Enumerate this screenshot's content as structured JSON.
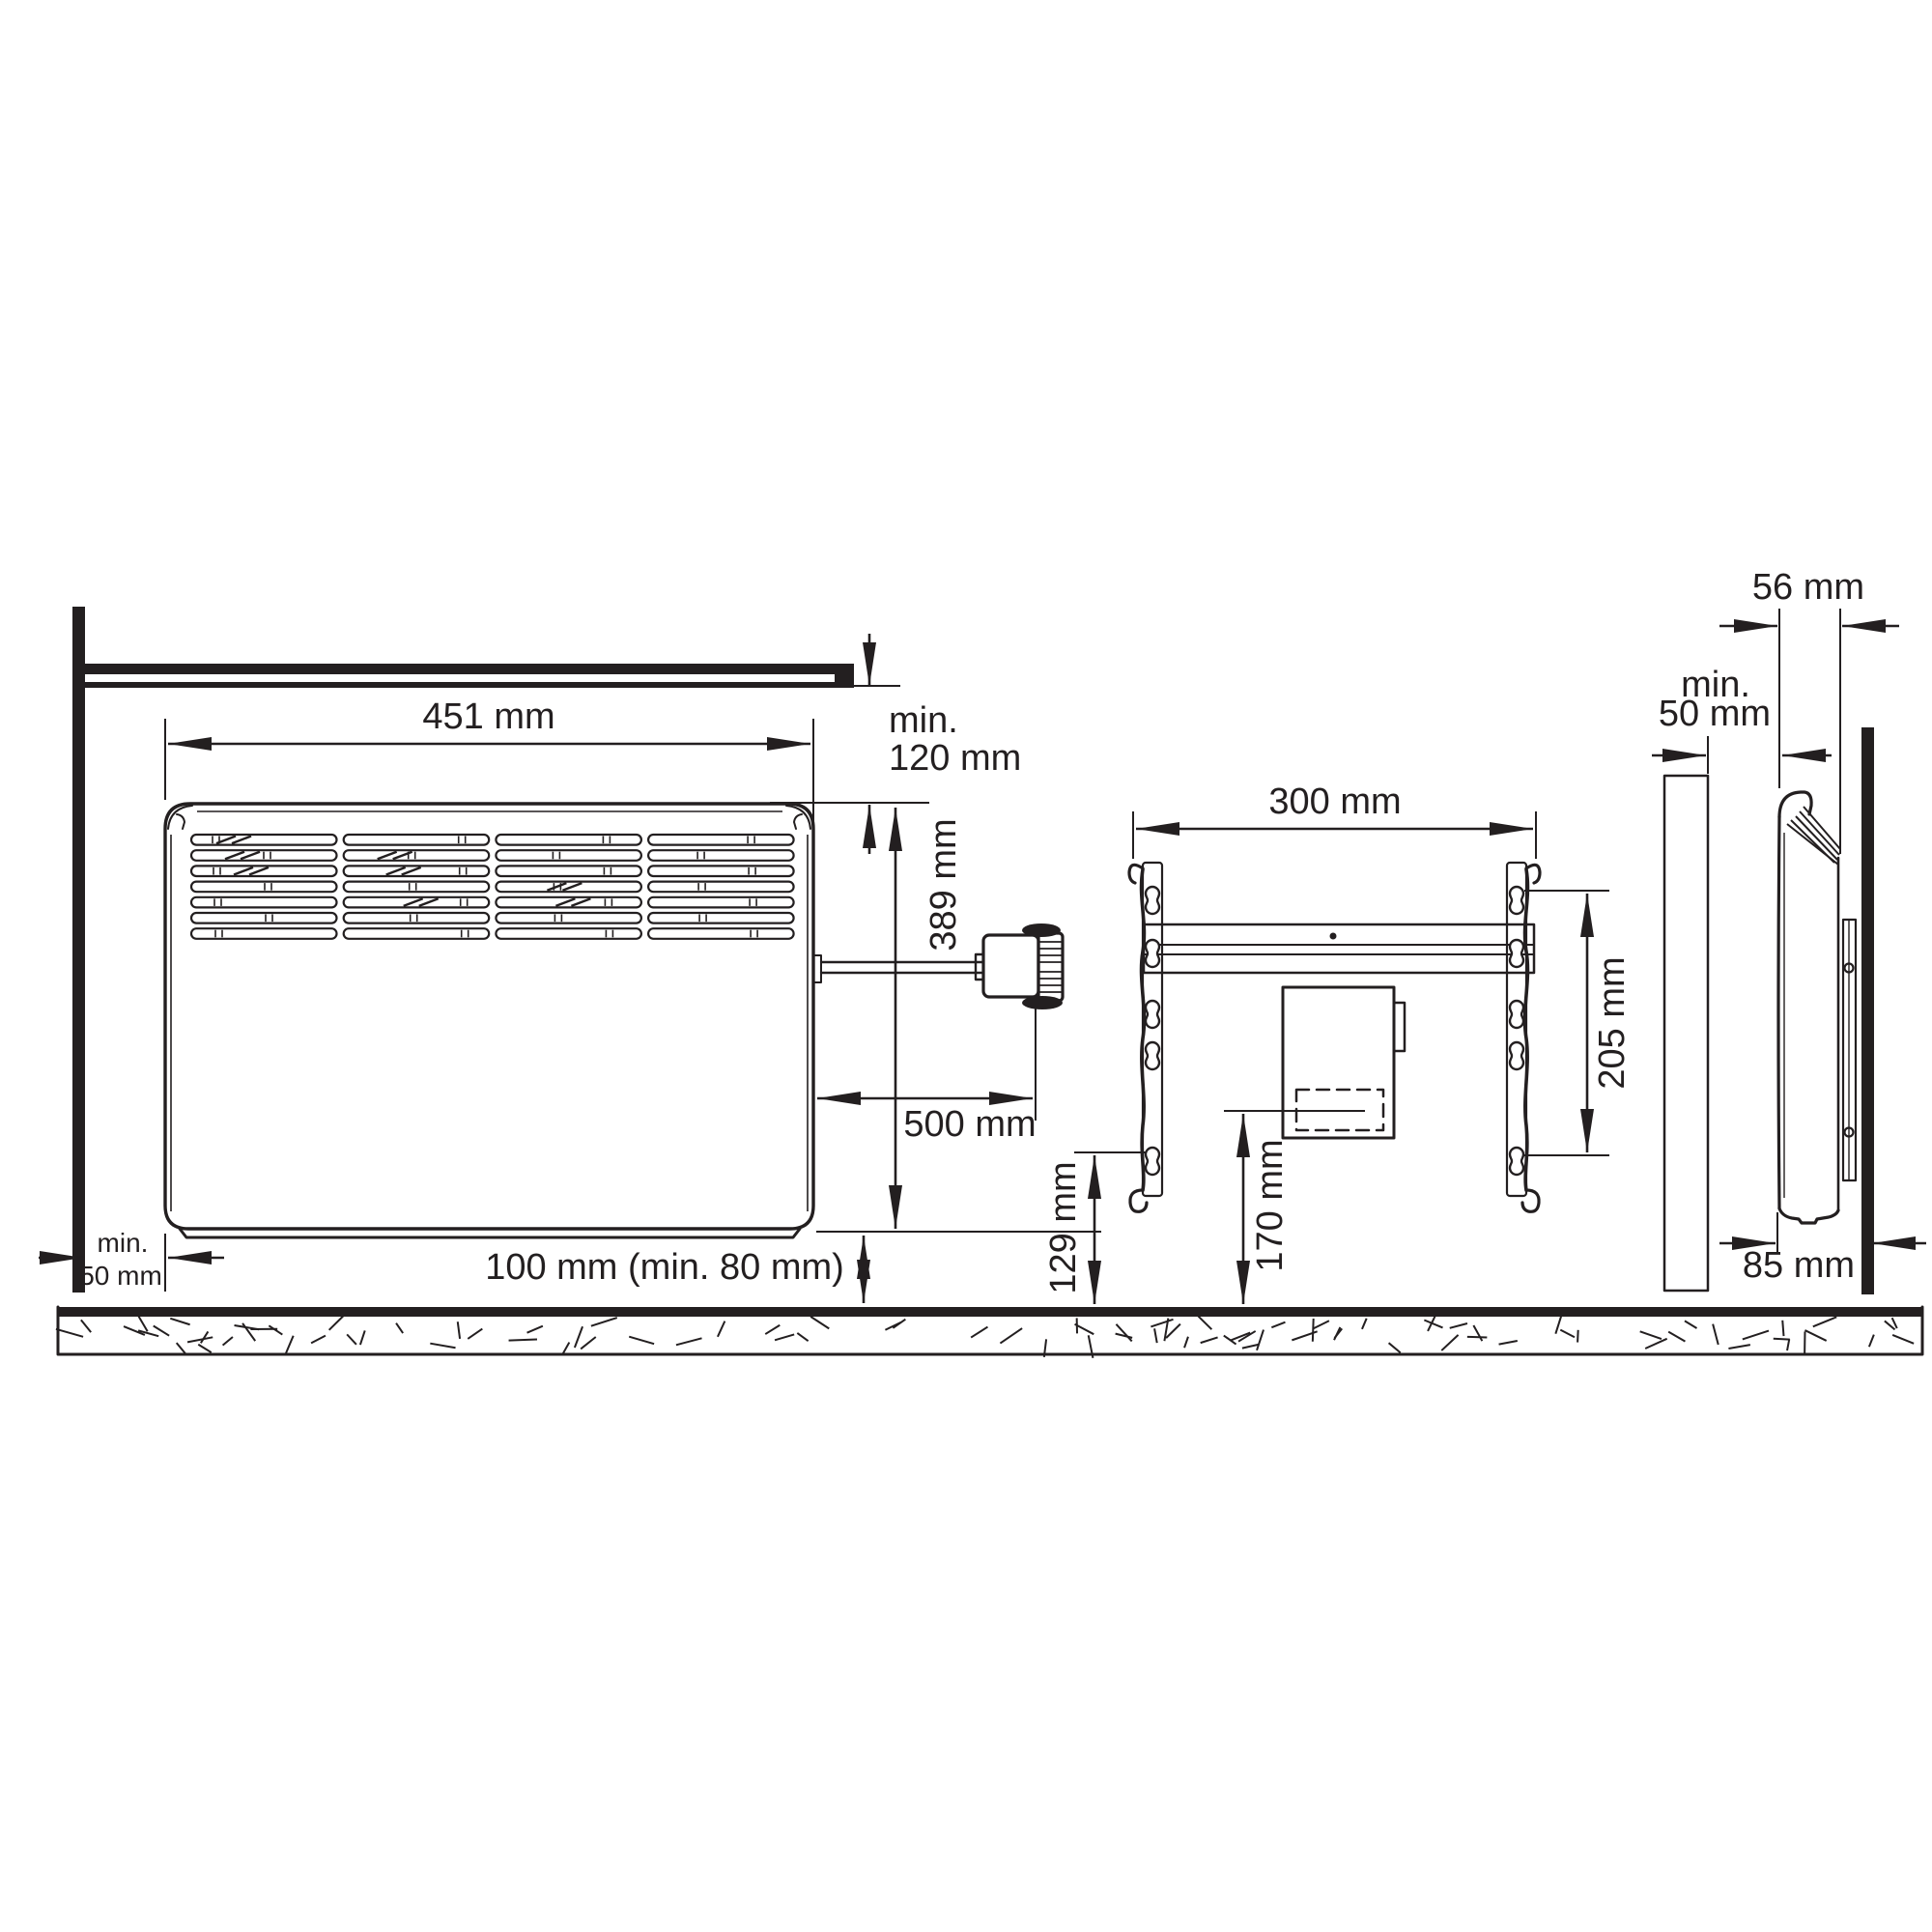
{
  "diagram": "convector-heater-installation-dimensions",
  "colors": {
    "ink": "#231f20",
    "hatch_fill": "#c9c9c9",
    "background": "#ffffff"
  },
  "front_view": {
    "width": "451 mm",
    "height": "389 mm",
    "ceiling_clearance_line1": "min.",
    "ceiling_clearance_line2": "120 mm",
    "wall_clearance_line1": "min.",
    "wall_clearance_line2": "50 mm",
    "floor_clearance": "100 mm (min. 80 mm)",
    "cord_length": "500 mm"
  },
  "bracket_view": {
    "hole_span_horizontal": "300 mm",
    "hole_span_vertical": "205 mm",
    "lower_hole_height": "129 mm",
    "outlet_height": "170 mm"
  },
  "side_view": {
    "device_depth": "56 mm",
    "side_clearance_line1": "min.",
    "side_clearance_line2": "50 mm",
    "front_to_wall": "85 mm"
  }
}
